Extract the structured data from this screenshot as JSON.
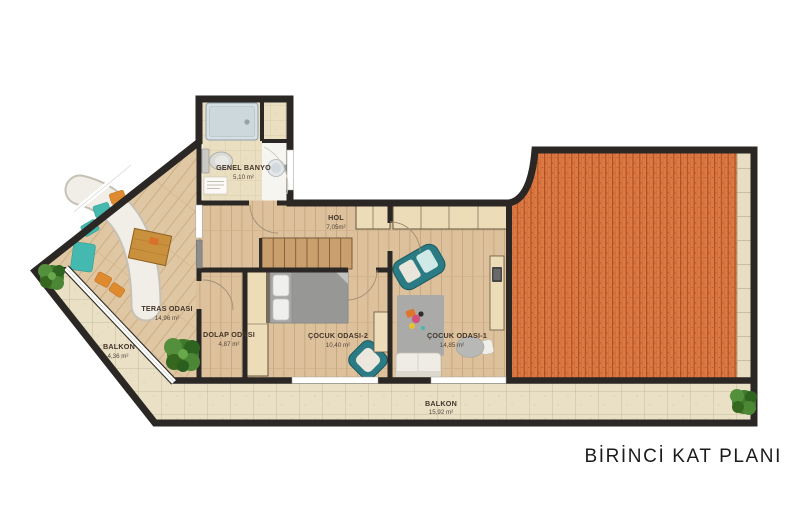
{
  "title": "BİRİNCİ KAT PLANI",
  "rooms": {
    "genel_banyo": {
      "name": "GENEL BANYO",
      "area": "5,10 m²"
    },
    "hol": {
      "name": "HOL",
      "area": "7,05m²"
    },
    "teras_odasi": {
      "name": "TERAS ODASI",
      "area": "14,96 m²"
    },
    "dolap_odasi": {
      "name": "DOLAP ODASI",
      "area": "4,87 m²"
    },
    "cocuk_odasi_2": {
      "name": "ÇOCUK ODASI-2",
      "area": "10,40 m²"
    },
    "cocuk_odasi_1": {
      "name": "ÇOCUK ODASI-1",
      "area": "14,85 m²"
    },
    "balkon_sol": {
      "name": "BALKON",
      "area": "4,36 m²"
    },
    "balkon_alt": {
      "name": "BALKON",
      "area": "15,92 m²"
    }
  },
  "colors": {
    "wall": "#2b2724",
    "wood_floor": "#dcc19c",
    "stone_floor": "#e9e0c6",
    "roof_tile": "#dc7944",
    "furniture_teal": "#2a7b83",
    "cushion_teal": "#43b9af",
    "cushion_orange": "#e08a2f",
    "wardrobe": "#ecdcb8"
  }
}
